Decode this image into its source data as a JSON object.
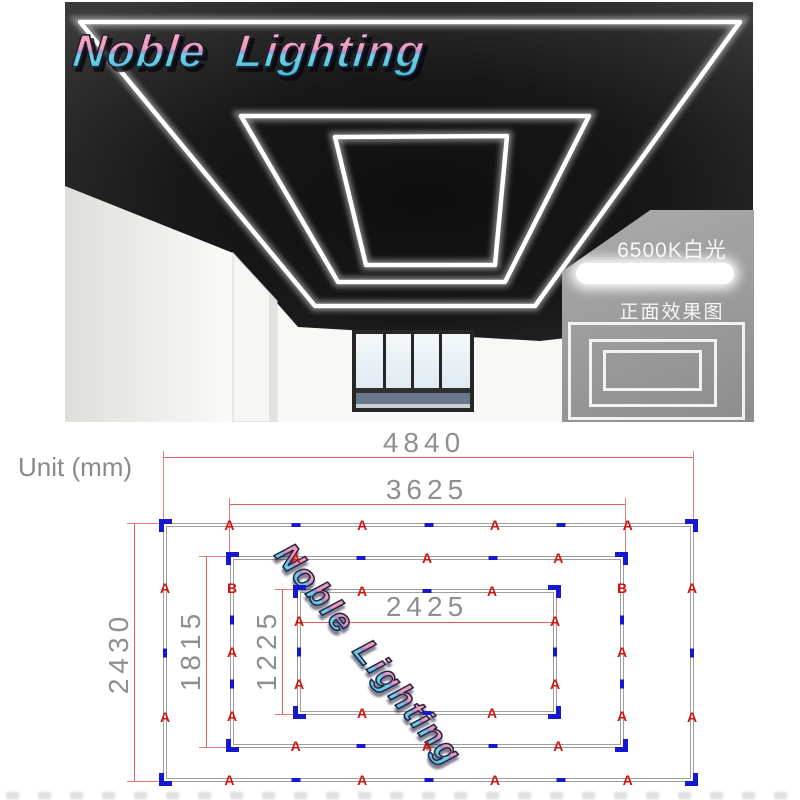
{
  "brand": {
    "logo_text": "Noble Lighting",
    "watermark_text": "Noble Lighting"
  },
  "info_panel": {
    "color_temp_label": "6500K白光",
    "front_view_label": "正面效果图"
  },
  "diagram": {
    "unit_label": "Unit (mm)",
    "dimensions": {
      "outer_width_mm": "4840",
      "middle_width_mm": "3625",
      "inner_width_mm": "2425",
      "outer_height_mm": "2430",
      "middle_height_mm": "1815",
      "inner_height_mm": "1225"
    },
    "edge_marks": {
      "outer_top": [
        "A",
        "d",
        "A",
        "d",
        "A",
        "d",
        "A"
      ],
      "outer_bottom": [
        "A",
        "d",
        "A",
        "d",
        "A",
        "d",
        "A"
      ],
      "outer_left": [
        "A",
        "d",
        "A"
      ],
      "outer_right": [
        "A",
        "d",
        "A"
      ],
      "middle_top": [
        "A",
        "d",
        "A",
        "d",
        "A"
      ],
      "middle_bottom": [
        "A",
        "d",
        "A",
        "d",
        "A"
      ],
      "middle_left": [
        "B",
        "d",
        "A",
        "d",
        "A"
      ],
      "middle_right": [
        "B",
        "d",
        "A",
        "d",
        "A"
      ],
      "inner_top": [
        "A",
        "d",
        "A"
      ],
      "inner_bottom": [
        "A",
        "d",
        "A"
      ],
      "inner_left": [
        "A",
        "d",
        "A"
      ],
      "inner_right": [
        "A",
        "d",
        "A"
      ]
    },
    "colors": {
      "segment_label_red": "#cf1512",
      "dimension_line_red": "#e05f58",
      "connector_blue": "#1518cc",
      "frame_edge_gray": "#9f9f9f",
      "dimension_text_gray": "#8f8f8f",
      "panel_gray": "#989898",
      "logo_pink": "#f2a3c0",
      "logo_cyan": "#6fd2e8"
    }
  }
}
